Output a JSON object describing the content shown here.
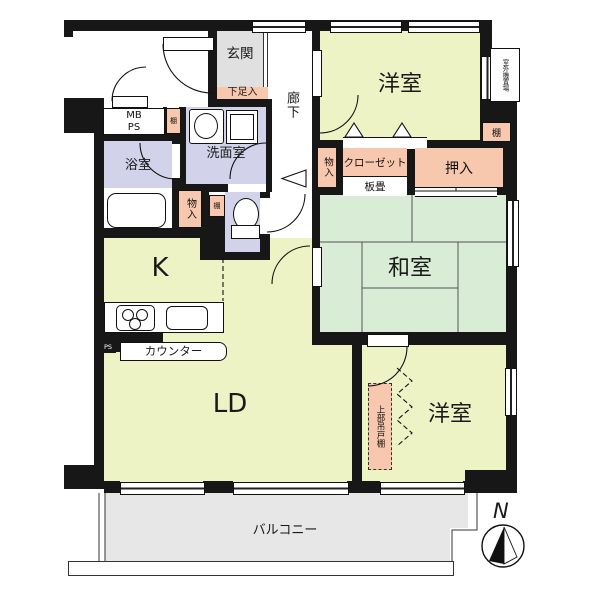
{
  "title": "apartment-floor-plan",
  "labels": {
    "genkan": "玄関",
    "getabako": "下足入",
    "hallway": "廊下",
    "western_room_top": "洋室",
    "outdoor_unit": "室外機置場",
    "shelf_right": "棚",
    "shelf_left": "棚",
    "shelf_toilet": "棚",
    "oshiire": "押入",
    "closet": "クローゼット",
    "itajiki": "板畳",
    "monoire_center": "物入",
    "monoire_west": "物入",
    "washitsu": "和室",
    "senmenshitsu": "洗面室",
    "bathroom": "浴室",
    "mb": "MB",
    "ps": "PS",
    "kitchen": "K",
    "counter": "カウンター",
    "ps_small": "PS",
    "living_dining": "LD",
    "hanging_cupboard": "上部吊戸棚",
    "western_room_bottom": "洋室",
    "balcony": "バルコニー",
    "compass_north": "N"
  },
  "colors": {
    "wall": "#171717",
    "western_room": "#eef3c6",
    "tatami_room": "#d9ecd6",
    "wet_area": "#d2d3ea",
    "storage": "#f7c7ae",
    "entrance": "#e0e0e0",
    "balcony": "#e7e7e7"
  }
}
